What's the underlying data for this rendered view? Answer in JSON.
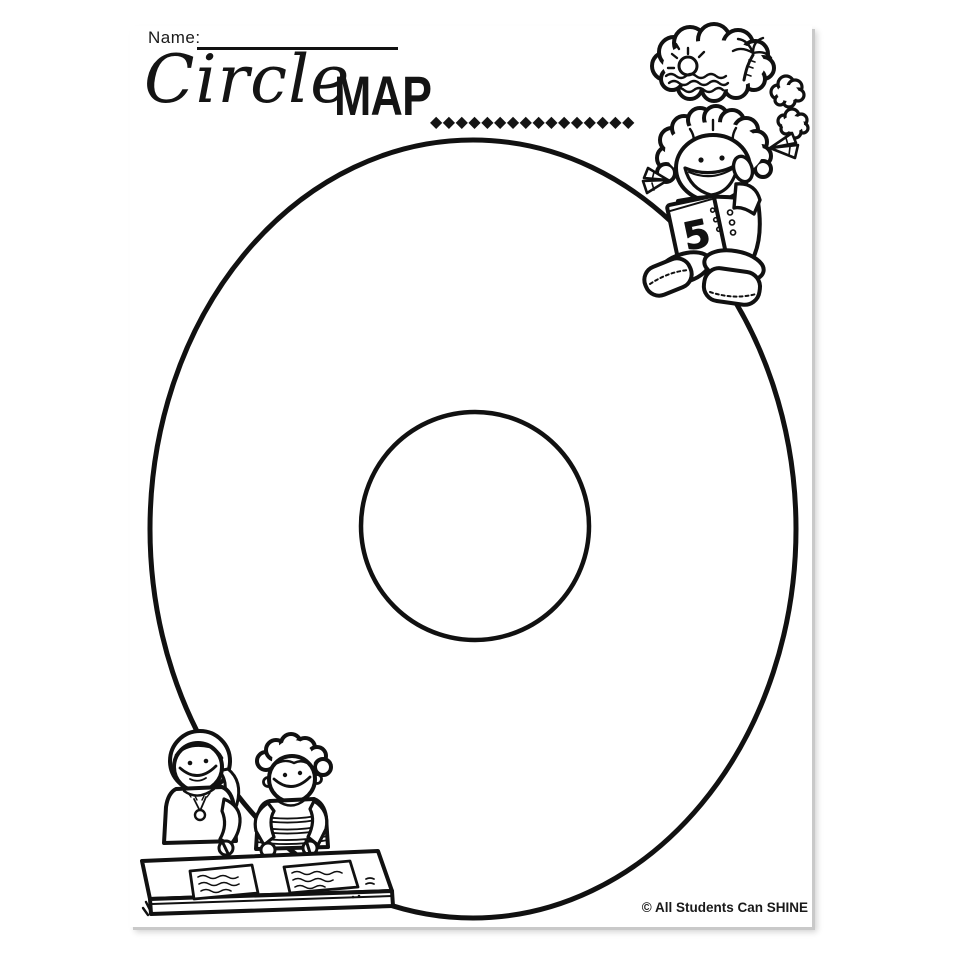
{
  "document": {
    "name_label": "Name:",
    "title_script": "Circle",
    "title_caps": "MAP",
    "title_dots": "◆◆◆◆◆◆◆◆◆◆◆◆◆◆◆◆",
    "copyright": "© All Students Can SHINE",
    "diagram_type": "circle-map graphic organizer (large outer ellipse with small inner circle, both blank)",
    "book_label": "5"
  },
  "clipart": {
    "top_right": "girl sitting on circle, thinking; thought cloud shows beach with sun, waves and palm tree; two small thought bubbles; holds book labeled 5",
    "bottom_left": "two children writing on papers at a desk"
  },
  "colors": {
    "ink": "#111111",
    "paper": "#ffffff",
    "shadow": "#c9c9c9"
  }
}
